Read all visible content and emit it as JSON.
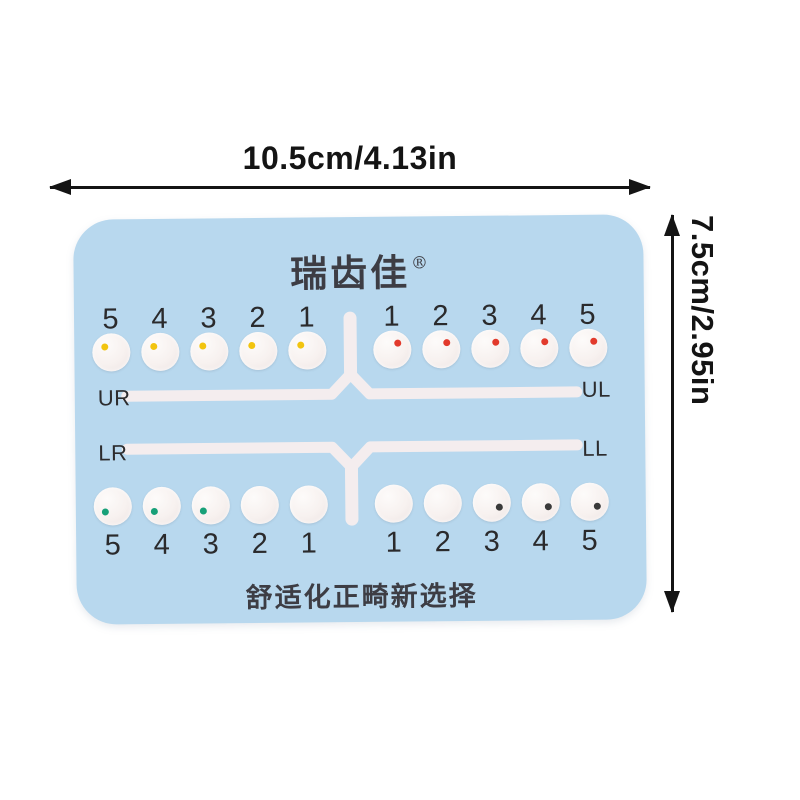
{
  "dimensions": {
    "width_label": "10.5cm/4.13in",
    "height_label": "7.5cm/2.95in"
  },
  "card": {
    "brand_name": "瑞齿佳",
    "registered_mark": "®",
    "slogan": "舒适化正畸新选择",
    "colors": {
      "card_bg": "#b8d8ee",
      "track": "#f4edee",
      "annotation": "#141414"
    },
    "quadrants": [
      {
        "id": "UR",
        "label": "UR",
        "row": "upper",
        "side": "left",
        "numbers": [
          "5",
          "4",
          "3",
          "2",
          "1"
        ],
        "dot_color": "#f2c40f",
        "dots": [
          true,
          true,
          true,
          true,
          true
        ]
      },
      {
        "id": "UL",
        "label": "UL",
        "row": "upper",
        "side": "right",
        "numbers": [
          "1",
          "2",
          "3",
          "4",
          "5"
        ],
        "dot_color": "#e23a2c",
        "dots": [
          true,
          true,
          true,
          true,
          true
        ]
      },
      {
        "id": "LR",
        "label": "LR",
        "row": "lower",
        "side": "left",
        "numbers": [
          "5",
          "4",
          "3",
          "2",
          "1"
        ],
        "dot_color": "#17a078",
        "dots": [
          true,
          true,
          true,
          false,
          false
        ]
      },
      {
        "id": "LL",
        "label": "LL",
        "row": "lower",
        "side": "right",
        "numbers": [
          "1",
          "2",
          "3",
          "4",
          "5"
        ],
        "dot_color": "#3a3a3a",
        "dots": [
          false,
          false,
          true,
          true,
          true
        ]
      }
    ]
  }
}
